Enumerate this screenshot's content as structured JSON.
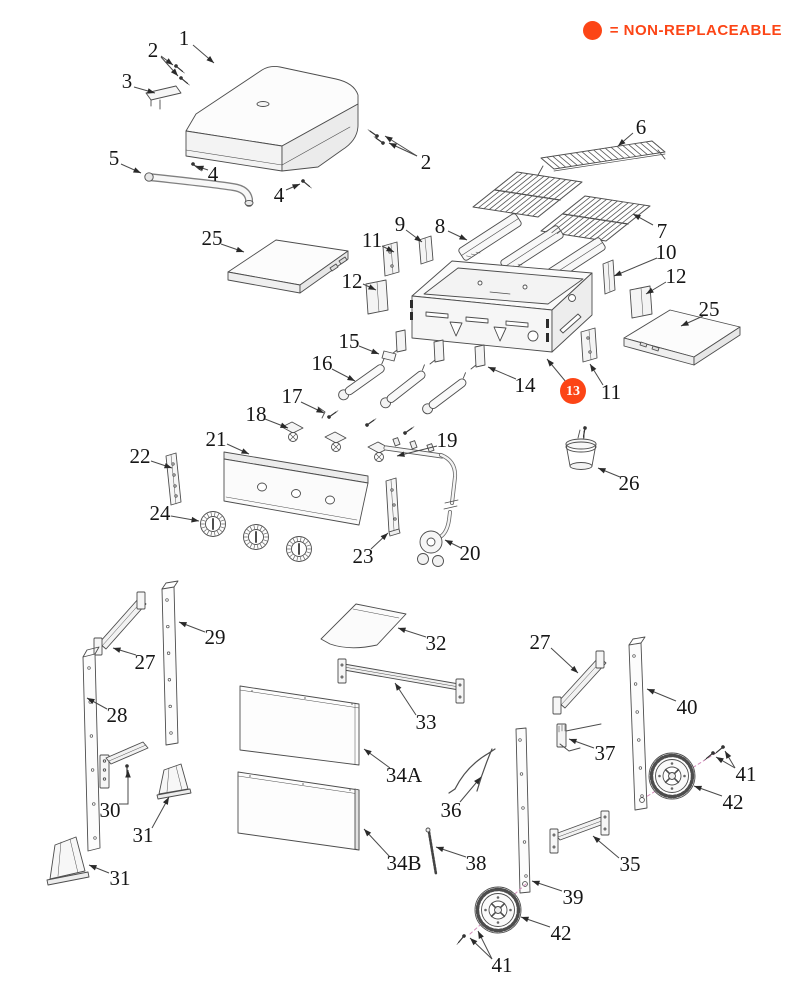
{
  "legend": {
    "text": "= NON-REPLACEABLE",
    "color": "#fc4516"
  },
  "highlight_color": "#fc4516",
  "diagram": {
    "callouts": [
      {
        "id": "1",
        "label": "1",
        "x": 184,
        "y": 38,
        "highlighted": false,
        "leaders": [
          [
            193,
            45,
            214,
            63
          ]
        ]
      },
      {
        "id": "2a",
        "label": "2",
        "x": 153,
        "y": 50,
        "highlighted": false,
        "leaders": [
          [
            161,
            56,
            173,
            65
          ],
          [
            161,
            57,
            178,
            76
          ]
        ]
      },
      {
        "id": "3",
        "label": "3",
        "x": 127,
        "y": 81,
        "highlighted": false,
        "leaders": [
          [
            134,
            87,
            155,
            93
          ]
        ]
      },
      {
        "id": "4a",
        "label": "4",
        "x": 213,
        "y": 174,
        "highlighted": false,
        "leaders": [
          [
            208,
            170,
            196,
            166
          ]
        ]
      },
      {
        "id": "4b",
        "label": "4",
        "x": 279,
        "y": 195,
        "highlighted": false,
        "leaders": [
          [
            286,
            190,
            300,
            184
          ]
        ]
      },
      {
        "id": "5",
        "label": "5",
        "x": 114,
        "y": 158,
        "highlighted": false,
        "leaders": [
          [
            121,
            164,
            141,
            173
          ]
        ]
      },
      {
        "id": "2b",
        "label": "2",
        "x": 426,
        "y": 162,
        "highlighted": false,
        "leaders": [
          [
            417,
            156,
            389,
            143
          ],
          [
            417,
            156,
            385,
            136
          ]
        ]
      },
      {
        "id": "6",
        "label": "6",
        "x": 641,
        "y": 127,
        "highlighted": false,
        "leaders": [
          [
            633,
            133,
            618,
            146
          ]
        ]
      },
      {
        "id": "7",
        "label": "7",
        "x": 662,
        "y": 231,
        "highlighted": false,
        "leaders": [
          [
            653,
            225,
            633,
            214
          ]
        ]
      },
      {
        "id": "8",
        "label": "8",
        "x": 440,
        "y": 226,
        "highlighted": false,
        "leaders": [
          [
            448,
            231,
            467,
            240
          ]
        ]
      },
      {
        "id": "9",
        "label": "9",
        "x": 400,
        "y": 224,
        "highlighted": false,
        "leaders": [
          [
            406,
            230,
            422,
            242
          ]
        ]
      },
      {
        "id": "10",
        "label": "10",
        "x": 666,
        "y": 252,
        "highlighted": false,
        "leaders": [
          [
            657,
            258,
            614,
            276
          ]
        ]
      },
      {
        "id": "11a",
        "label": "11",
        "x": 372,
        "y": 240,
        "highlighted": false,
        "leaders": [
          [
            382,
            246,
            394,
            252
          ]
        ]
      },
      {
        "id": "12a",
        "label": "12",
        "x": 352,
        "y": 281,
        "highlighted": false,
        "leaders": [
          [
            363,
            284,
            376,
            290
          ]
        ]
      },
      {
        "id": "12b",
        "label": "12",
        "x": 676,
        "y": 276,
        "highlighted": false,
        "leaders": [
          [
            666,
            282,
            646,
            294
          ]
        ]
      },
      {
        "id": "11b",
        "label": "11",
        "x": 611,
        "y": 392,
        "highlighted": false,
        "leaders": [
          [
            603,
            385,
            590,
            364
          ]
        ]
      },
      {
        "id": "13",
        "label": "13",
        "x": 573,
        "y": 391,
        "highlighted": true,
        "leaders": [
          [
            566,
            382,
            547,
            359
          ]
        ]
      },
      {
        "id": "14",
        "label": "14",
        "x": 525,
        "y": 385,
        "highlighted": false,
        "leaders": [
          [
            516,
            379,
            488,
            367
          ]
        ]
      },
      {
        "id": "15",
        "label": "15",
        "x": 349,
        "y": 341,
        "highlighted": false,
        "leaders": [
          [
            359,
            346,
            379,
            354
          ]
        ]
      },
      {
        "id": "16",
        "label": "16",
        "x": 322,
        "y": 363,
        "highlighted": false,
        "leaders": [
          [
            332,
            369,
            355,
            381
          ]
        ]
      },
      {
        "id": "17",
        "label": "17",
        "x": 292,
        "y": 396,
        "highlighted": false,
        "leaders": [
          [
            301,
            402,
            324,
            413
          ]
        ]
      },
      {
        "id": "18",
        "label": "18",
        "x": 256,
        "y": 414,
        "highlighted": false,
        "leaders": [
          [
            265,
            419,
            288,
            428
          ]
        ]
      },
      {
        "id": "19",
        "label": "19",
        "x": 447,
        "y": 440,
        "highlighted": false,
        "leaders": [
          [
            437,
            446,
            397,
            456
          ]
        ]
      },
      {
        "id": "20",
        "label": "20",
        "x": 470,
        "y": 553,
        "highlighted": false,
        "leaders": [
          [
            461,
            548,
            445,
            540
          ]
        ]
      },
      {
        "id": "21",
        "label": "21",
        "x": 216,
        "y": 439,
        "highlighted": false,
        "leaders": [
          [
            227,
            444,
            249,
            454
          ]
        ]
      },
      {
        "id": "22",
        "label": "22",
        "x": 140,
        "y": 456,
        "highlighted": false,
        "leaders": [
          [
            151,
            461,
            172,
            468
          ]
        ]
      },
      {
        "id": "23",
        "label": "23",
        "x": 363,
        "y": 556,
        "highlighted": false,
        "leaders": [
          [
            371,
            549,
            388,
            533
          ]
        ]
      },
      {
        "id": "24",
        "label": "24",
        "x": 160,
        "y": 513,
        "highlighted": false,
        "leaders": [
          [
            171,
            516,
            199,
            521
          ]
        ]
      },
      {
        "id": "25a",
        "label": "25",
        "x": 212,
        "y": 238,
        "highlighted": false,
        "leaders": [
          [
            221,
            244,
            244,
            252
          ]
        ]
      },
      {
        "id": "25b",
        "label": "25",
        "x": 709,
        "y": 309,
        "highlighted": false,
        "leaders": [
          [
            703,
            316,
            681,
            326
          ]
        ]
      },
      {
        "id": "26",
        "label": "26",
        "x": 629,
        "y": 483,
        "highlighted": false,
        "leaders": [
          [
            620,
            477,
            598,
            468
          ]
        ]
      },
      {
        "id": "27a",
        "label": "27",
        "x": 145,
        "y": 662,
        "highlighted": false,
        "leaders": [
          [
            136,
            655,
            113,
            648
          ]
        ]
      },
      {
        "id": "27b",
        "label": "27",
        "x": 540,
        "y": 642,
        "highlighted": false,
        "leaders": [
          [
            551,
            648,
            578,
            673
          ]
        ]
      },
      {
        "id": "28",
        "label": "28",
        "x": 117,
        "y": 715,
        "highlighted": false,
        "leaders": [
          [
            107,
            709,
            87,
            698
          ]
        ]
      },
      {
        "id": "29",
        "label": "29",
        "x": 215,
        "y": 637,
        "highlighted": false,
        "leaders": [
          [
            205,
            632,
            179,
            622
          ]
        ]
      },
      {
        "id": "30",
        "label": "30",
        "x": 110,
        "y": 810,
        "highlighted": false,
        "leaders": [
          [
            119,
            804,
            128,
            804,
            128,
            770
          ]
        ]
      },
      {
        "id": "31a",
        "label": "31",
        "x": 143,
        "y": 835,
        "highlighted": false,
        "leaders": [
          [
            152,
            828,
            169,
            797
          ]
        ]
      },
      {
        "id": "31b",
        "label": "31",
        "x": 120,
        "y": 878,
        "highlighted": false,
        "leaders": [
          [
            109,
            873,
            89,
            865
          ]
        ]
      },
      {
        "id": "32",
        "label": "32",
        "x": 436,
        "y": 643,
        "highlighted": false,
        "leaders": [
          [
            426,
            637,
            398,
            628
          ]
        ]
      },
      {
        "id": "33",
        "label": "33",
        "x": 426,
        "y": 722,
        "highlighted": false,
        "leaders": [
          [
            416,
            715,
            395,
            683
          ]
        ]
      },
      {
        "id": "34A",
        "label": "34A",
        "x": 404,
        "y": 775,
        "highlighted": false,
        "leaders": [
          [
            390,
            768,
            364,
            749
          ]
        ]
      },
      {
        "id": "34B",
        "label": "34B",
        "x": 404,
        "y": 863,
        "highlighted": false,
        "leaders": [
          [
            390,
            857,
            364,
            829
          ]
        ]
      },
      {
        "id": "35",
        "label": "35",
        "x": 630,
        "y": 864,
        "highlighted": false,
        "leaders": [
          [
            619,
            858,
            593,
            836
          ]
        ]
      },
      {
        "id": "36",
        "label": "36",
        "x": 451,
        "y": 810,
        "highlighted": false,
        "leaders": [
          [
            460,
            802,
            481,
            777
          ]
        ]
      },
      {
        "id": "37",
        "label": "37",
        "x": 605,
        "y": 753,
        "highlighted": false,
        "leaders": [
          [
            594,
            748,
            569,
            739
          ]
        ]
      },
      {
        "id": "38",
        "label": "38",
        "x": 476,
        "y": 863,
        "highlighted": false,
        "leaders": [
          [
            466,
            857,
            436,
            847
          ]
        ]
      },
      {
        "id": "39",
        "label": "39",
        "x": 573,
        "y": 897,
        "highlighted": false,
        "leaders": [
          [
            562,
            891,
            532,
            881
          ]
        ]
      },
      {
        "id": "40",
        "label": "40",
        "x": 687,
        "y": 707,
        "highlighted": false,
        "leaders": [
          [
            676,
            701,
            647,
            689
          ]
        ]
      },
      {
        "id": "41a",
        "label": "41",
        "x": 746,
        "y": 774,
        "highlighted": false,
        "leaders": [
          [
            735,
            768,
            716,
            757
          ],
          [
            735,
            768,
            725,
            751
          ]
        ]
      },
      {
        "id": "42a",
        "label": "42",
        "x": 733,
        "y": 802,
        "highlighted": false,
        "leaders": [
          [
            722,
            796,
            694,
            786
          ]
        ]
      },
      {
        "id": "42b",
        "label": "42",
        "x": 561,
        "y": 933,
        "highlighted": false,
        "leaders": [
          [
            550,
            927,
            521,
            917
          ]
        ]
      },
      {
        "id": "41b",
        "label": "41",
        "x": 502,
        "y": 965,
        "highlighted": false,
        "leaders": [
          [
            492,
            959,
            470,
            938
          ],
          [
            492,
            959,
            478,
            931
          ]
        ]
      }
    ]
  }
}
